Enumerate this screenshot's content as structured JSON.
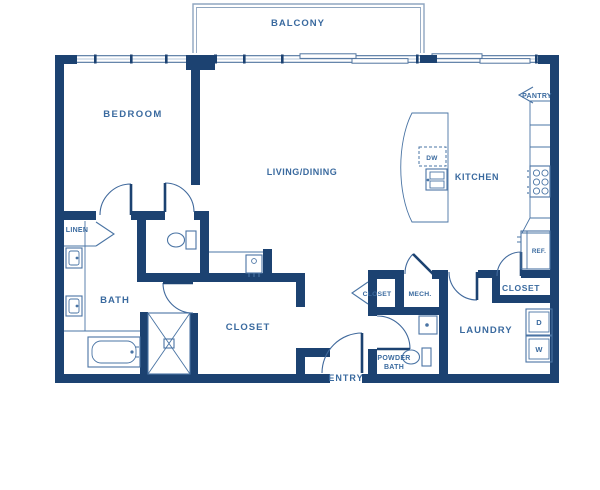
{
  "floor_plan": {
    "rooms": {
      "balcony": "BALCONY",
      "bedroom": "BEDROOM",
      "living_dining": "LIVING/DINING",
      "kitchen": "KITCHEN",
      "pantry": "PANTRY",
      "linen": "LINEN",
      "bath": "BATH",
      "bedroom_closet": "CLOSET",
      "hall_closet": "CLOSET",
      "mech": "MECH.",
      "powder_line1": "POWDER",
      "powder_line2": "BATH",
      "entry": "ENTRY",
      "laundry": "LAUNDRY",
      "kitchen_closet": "CLOSET"
    },
    "appliances": {
      "dishwasher": "DW",
      "refrigerator": "REF.",
      "dryer": "D",
      "washer": "W"
    },
    "colors": {
      "wall": "#1c4271",
      "label": "#3a6a9f",
      "fixture": "#4a74a4",
      "window_frame": "#51749f",
      "balcony_outline": "#8fa6c0",
      "background": "#ffffff"
    }
  }
}
